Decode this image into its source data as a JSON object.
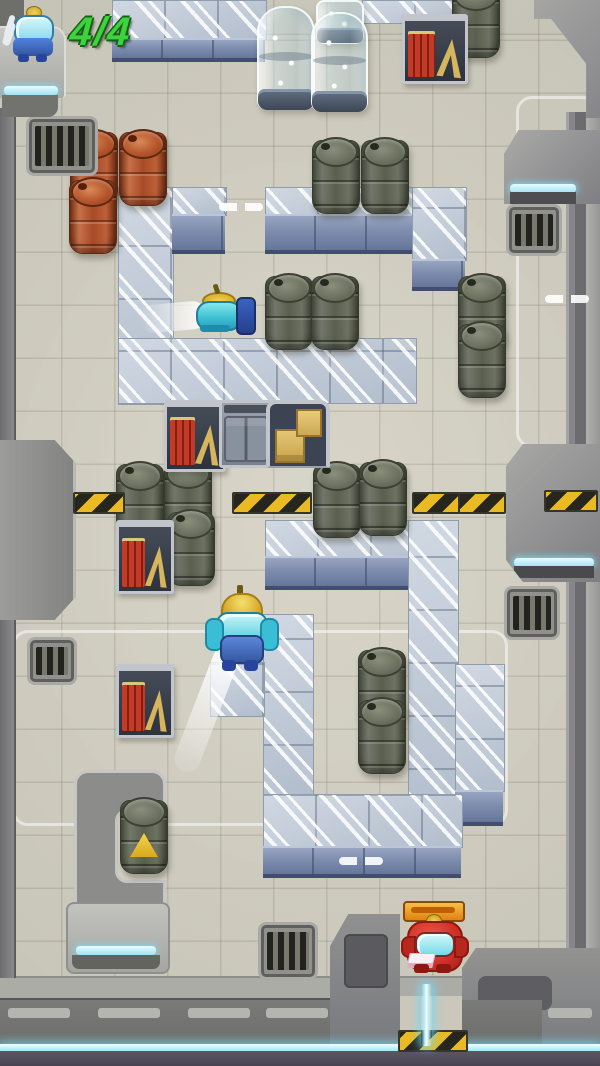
{
  "hud": {
    "counter": "4/4",
    "counter_color": "#3fd23f",
    "character_icon": "blue-robot-icon"
  },
  "palette": {
    "floor": "#d4d1c3",
    "wall_gray": "#8c8c8a",
    "metal_block_top": "#c8d1dc",
    "metal_block_front": "#7e8dad",
    "cyan_glow": "#a2e6f6",
    "hazard_yellow": "#e9ba24",
    "barrel_red": "#b14f2c",
    "barrel_dark": "#5d6253",
    "robot_blue": "#4f7ad8",
    "robot_red": "#d63a30",
    "beam_cyan": "#b8f2ff"
  },
  "entities": [
    {
      "type": "zone",
      "name": "zone-outline-top-right",
      "x": 516,
      "y": 96,
      "w": 76,
      "h": 346
    },
    {
      "type": "zone",
      "name": "zone-outline-bottom-left",
      "x": 12,
      "y": 630,
      "w": 490,
      "h": 190
    },
    {
      "type": "mblock-streak",
      "name": "metal-wall-top-band",
      "x": 112,
      "y": 0,
      "w": 153,
      "h": 38
    },
    {
      "type": "mblock-front",
      "name": "metal-wall-top-band-front",
      "x": 112,
      "y": 38,
      "w": 153,
      "h": 18
    },
    {
      "type": "mblock-streak",
      "name": "metal-wall-shelf-band",
      "x": 362,
      "y": 0,
      "w": 116,
      "h": 22
    },
    {
      "type": "mblock-streak",
      "name": "metal-column",
      "x": 118,
      "y": 187,
      "w": 54,
      "h": 216
    },
    {
      "type": "mblock-streak",
      "name": "metal-block",
      "x": 172,
      "y": 187,
      "w": 53,
      "h": 27
    },
    {
      "type": "mblock-front",
      "name": "metal-block-front",
      "x": 172,
      "y": 214,
      "w": 53,
      "h": 34
    },
    {
      "type": "mblock-streak",
      "name": "metal-row",
      "x": 265,
      "y": 187,
      "w": 150,
      "h": 27
    },
    {
      "type": "mblock-front",
      "name": "metal-row-front",
      "x": 265,
      "y": 214,
      "w": 150,
      "h": 34
    },
    {
      "type": "mblock-streak",
      "name": "metal-column",
      "x": 412,
      "y": 187,
      "w": 53,
      "h": 72
    },
    {
      "type": "mblock-front",
      "name": "metal-column-front",
      "x": 412,
      "y": 259,
      "w": 53,
      "h": 26
    },
    {
      "type": "mblock-streak",
      "name": "metal-row",
      "x": 118,
      "y": 338,
      "w": 297,
      "h": 64
    },
    {
      "type": "mblock-streak",
      "name": "metal-row",
      "x": 265,
      "y": 520,
      "w": 191,
      "h": 36
    },
    {
      "type": "mblock-front",
      "name": "metal-row-front",
      "x": 265,
      "y": 556,
      "w": 191,
      "h": 28
    },
    {
      "type": "mblock-streak",
      "name": "metal-column",
      "x": 408,
      "y": 520,
      "w": 49,
      "h": 300
    },
    {
      "type": "mblock-streak",
      "name": "metal-column",
      "x": 263,
      "y": 614,
      "w": 49,
      "h": 182
    },
    {
      "type": "mblock-streak",
      "name": "metal-block",
      "x": 210,
      "y": 662,
      "w": 53,
      "h": 53
    },
    {
      "type": "mblock-streak",
      "name": "metal-column",
      "x": 455,
      "y": 664,
      "w": 48,
      "h": 126
    },
    {
      "type": "mblock-front",
      "name": "metal-column-front",
      "x": 455,
      "y": 790,
      "w": 48,
      "h": 30
    },
    {
      "type": "mblock-streak",
      "name": "metal-row",
      "x": 263,
      "y": 794,
      "w": 198,
      "h": 52
    },
    {
      "type": "mblock-front",
      "name": "metal-row-front",
      "x": 263,
      "y": 846,
      "w": 198,
      "h": 26
    },
    {
      "type": "barrel-red",
      "name": "red-barrel",
      "x": 70,
      "y": 132
    },
    {
      "type": "barrel-red",
      "name": "red-barrel",
      "x": 119,
      "y": 132
    },
    {
      "type": "barrel-red",
      "name": "red-barrel",
      "x": 69,
      "y": 180
    },
    {
      "type": "barrel-dark",
      "name": "dark-barrel",
      "x": 452,
      "y": -16
    },
    {
      "type": "barrel-dark",
      "name": "dark-barrel",
      "x": 312,
      "y": 140
    },
    {
      "type": "barrel-dark",
      "name": "dark-barrel",
      "x": 361,
      "y": 140
    },
    {
      "type": "barrel-dark",
      "name": "dark-barrel",
      "x": 265,
      "y": 276
    },
    {
      "type": "barrel-dark",
      "name": "dark-barrel",
      "x": 311,
      "y": 276
    },
    {
      "type": "barrel-dark",
      "name": "dark-barrel",
      "x": 458,
      "y": 276
    },
    {
      "type": "barrel-dark",
      "name": "dark-barrel",
      "x": 458,
      "y": 324
    },
    {
      "type": "barrel-dark",
      "name": "dark-barrel",
      "x": 116,
      "y": 464
    },
    {
      "type": "barrel-dark",
      "name": "dark-barrel",
      "x": 164,
      "y": 462
    },
    {
      "type": "barrel-dark",
      "name": "dark-barrel",
      "x": 167,
      "y": 512
    },
    {
      "type": "barrel-dark",
      "name": "dark-barrel",
      "x": 313,
      "y": 464
    },
    {
      "type": "barrel-dark",
      "name": "dark-barrel",
      "x": 359,
      "y": 462
    },
    {
      "type": "barrel-dark",
      "name": "dark-barrel",
      "x": 358,
      "y": 650
    },
    {
      "type": "barrel-dark",
      "name": "dark-barrel",
      "x": 358,
      "y": 700
    },
    {
      "type": "barrel-dark",
      "name": "hazard-barrel",
      "variant": "sign",
      "x": 120,
      "y": 800
    },
    {
      "type": "vent",
      "name": "vent-grate",
      "x": 26,
      "y": 116,
      "w": 66,
      "h": 54
    },
    {
      "type": "vent",
      "name": "vent-grate",
      "x": 506,
      "y": 204,
      "w": 50,
      "h": 46
    },
    {
      "type": "vent",
      "name": "vent-grate",
      "x": 27,
      "y": 637,
      "w": 44,
      "h": 42
    },
    {
      "type": "vent",
      "name": "vent-grate",
      "x": 504,
      "y": 586,
      "w": 50,
      "h": 48
    },
    {
      "type": "vent",
      "name": "vent-grate",
      "x": 258,
      "y": 922,
      "w": 54,
      "h": 52
    },
    {
      "type": "hazard",
      "name": "hazard-stripe",
      "x": 73,
      "y": 492,
      "w": 48
    },
    {
      "type": "hazard",
      "name": "hazard-stripe",
      "x": 232,
      "y": 492,
      "w": 76
    },
    {
      "type": "hazard",
      "name": "hazard-stripe",
      "x": 412,
      "y": 492,
      "w": 44
    },
    {
      "type": "hazard",
      "name": "hazard-stripe",
      "x": 458,
      "y": 492,
      "w": 44
    },
    {
      "type": "hazard",
      "name": "hazard-stripe",
      "x": 544,
      "y": 490,
      "w": 50
    },
    {
      "type": "hazard",
      "name": "exit-hazard-stripe",
      "x": 398,
      "y": 1030,
      "w": 66
    },
    {
      "type": "shelf",
      "name": "supply-shelf",
      "x": 402,
      "y": 14,
      "w": 60,
      "h": 60
    },
    {
      "type": "shelf",
      "name": "supply-shelf",
      "x": 164,
      "y": 400,
      "w": 56,
      "h": 62
    },
    {
      "type": "shelf",
      "name": "supply-shelf",
      "x": 116,
      "y": 520,
      "w": 52,
      "h": 64
    },
    {
      "type": "shelf",
      "name": "supply-shelf",
      "x": 116,
      "y": 664,
      "w": 52,
      "h": 64
    },
    {
      "type": "locker",
      "name": "locker-cabinet",
      "x": 219,
      "y": 400
    },
    {
      "type": "crates",
      "name": "crate-stack",
      "x": 266,
      "y": 400
    },
    {
      "type": "capsule-partial",
      "name": "glass-capsule-upper",
      "x": 316,
      "y": 0,
      "w": 44,
      "h": 40
    },
    {
      "type": "capsule",
      "name": "glass-capsule",
      "x": 257,
      "y": 6,
      "w": 54,
      "h": 100
    },
    {
      "type": "capsule",
      "name": "glass-capsule",
      "x": 311,
      "y": 12,
      "w": 53,
      "h": 96
    },
    {
      "type": "dash-pair",
      "name": "passage-marker",
      "x": 219,
      "y": 203
    },
    {
      "type": "dash-pair",
      "name": "passage-marker",
      "x": 545,
      "y": 295
    },
    {
      "type": "dash-pair",
      "name": "passage-marker",
      "x": 339,
      "y": 857
    },
    {
      "type": "road-dash",
      "name": "road-dash",
      "x": 8,
      "y": 1008
    },
    {
      "type": "road-dash",
      "name": "road-dash",
      "x": 98,
      "y": 1008
    },
    {
      "type": "road-dash",
      "name": "road-dash",
      "x": 188,
      "y": 1008
    },
    {
      "type": "road-dash",
      "name": "road-dash",
      "x": 266,
      "y": 1008
    },
    {
      "type": "road-dash",
      "name": "road-dash",
      "x": 548,
      "y": 1008,
      "w": 44
    },
    {
      "type": "trail-h",
      "name": "dash-trail",
      "x": 140,
      "y": 303
    },
    {
      "type": "trail-d",
      "name": "dash-trail",
      "x": 217,
      "y": 648
    },
    {
      "type": "beam",
      "name": "exit-beam",
      "x": 421,
      "y": 984
    },
    {
      "type": "robot-flying",
      "name": "blue-robot-flying",
      "interactable": true,
      "x": 192,
      "y": 288
    },
    {
      "type": "robot-standing",
      "name": "blue-robot",
      "interactable": true,
      "x": 210,
      "y": 585
    },
    {
      "type": "robot-red",
      "name": "red-robot-exit",
      "interactable": true,
      "x": 402,
      "y": 900
    },
    {
      "type": "hud-char",
      "name": "hud-character-icon",
      "x": 9,
      "y": 6
    }
  ]
}
